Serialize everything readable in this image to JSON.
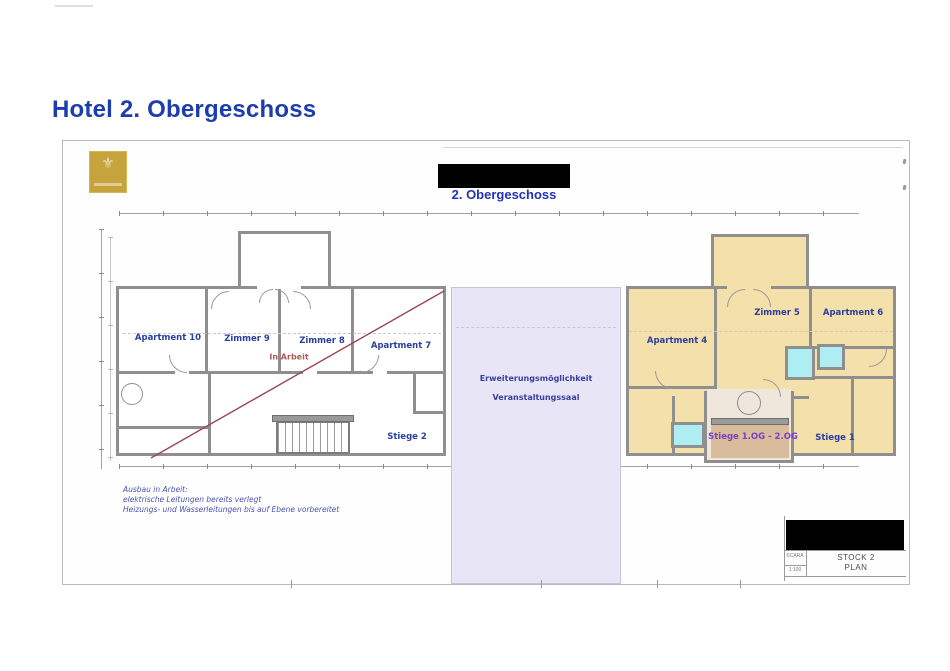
{
  "page": {
    "title": "Hotel 2. Obergeschoss"
  },
  "sheet": {
    "subtitle": "2. Obergeschoss",
    "logo_icon": "⚜",
    "left_building": {
      "rooms": [
        "Apartment 10",
        "Zimmer 9",
        "Zimmer 8",
        "Apartment 7"
      ],
      "status": "In Arbeit",
      "stair": "Stiege 2"
    },
    "expansion": {
      "line1": "Erweiterungsmöglichkeit",
      "line2": "Veranstaltungssaal"
    },
    "right_building": {
      "rooms": [
        "Apartment 4",
        "Zimmer 5",
        "Apartment 6"
      ],
      "stairwell": "Stiege 1.OG - 2.OG",
      "stair": "Stiege 1"
    },
    "notes": {
      "line1": "Ausbau in Arbeit:",
      "line2": "elektrische Leitungen bereits verlegt",
      "line3": "Heizungs- und Wasserleitungen bis auf Ebene vorbereitet"
    },
    "title_block": {
      "scale_label": "SCARA",
      "scale_value": "1:100",
      "sheet_name_line1": "STOCK 2",
      "sheet_name_line2": "PLAN"
    }
  },
  "colors": {
    "accent_blue": "#1d3dae",
    "label_blue": "#2b3f9e",
    "subtitle_blue": "#2233b3",
    "room_tan": "#f4e0ab",
    "expansion_lavender": "#e8e5f6",
    "bath_cyan": "#aeeef2",
    "strike_red": "#9c4652",
    "stair_label_purple": "#7b3fc4",
    "logo_gold": "#c7a33c",
    "stair_brown": "#d9bc9b",
    "wall_gray": "#8f8f8f"
  }
}
